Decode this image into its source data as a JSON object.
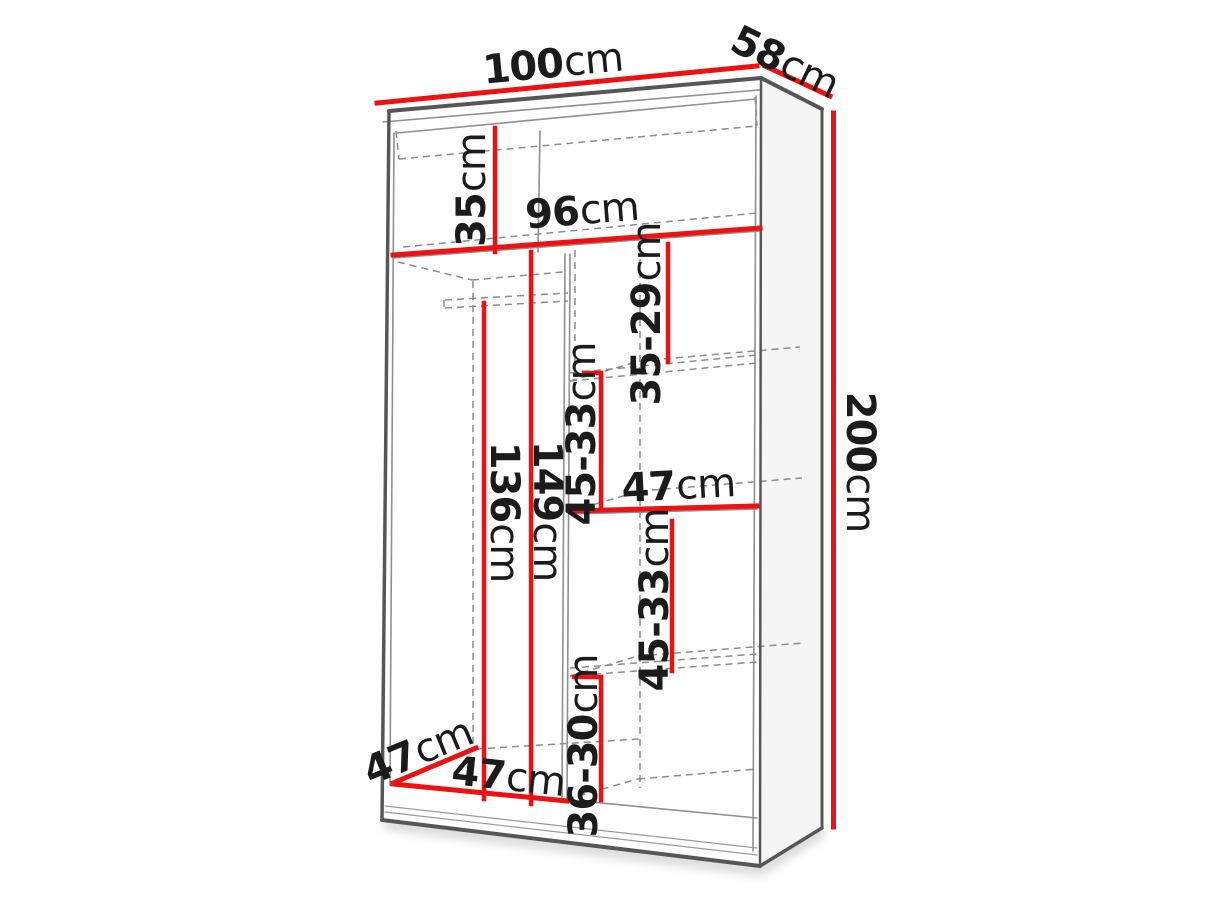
{
  "colors": {
    "dimension_red": "#ee1111",
    "outline_dark": "#565656",
    "outline_light": "#8f8f8f",
    "hidden_line_gray": "#8c8c8c",
    "label_text": "#1b1b1b",
    "side_panel_fill": "#f5f5f5"
  },
  "labels": {
    "top_width": {
      "value": "100",
      "unit": "cm"
    },
    "top_depth": {
      "value": "58",
      "unit": "cm"
    },
    "height": {
      "value": "200",
      "unit": "cm"
    },
    "top_compartment": {
      "value": "35",
      "unit": "cm"
    },
    "interior_width": {
      "value": "96",
      "unit": "cm"
    },
    "right_upper_compartment": {
      "value": "35-29",
      "unit": "cm"
    },
    "right_middle_compartment": {
      "value": "45-33",
      "unit": "cm"
    },
    "hanging_height": {
      "value": "136",
      "unit": "cm"
    },
    "interior_height": {
      "value": "149",
      "unit": "cm"
    },
    "shelf_width": {
      "value": "47",
      "unit": "cm"
    },
    "right_lower_compartment": {
      "value": "45-33",
      "unit": "cm"
    },
    "right_bottom_compartment": {
      "value": "36-30",
      "unit": "cm"
    },
    "interior_depth": {
      "value": "47",
      "unit": "cm"
    },
    "left_section_width": {
      "value": "47",
      "unit": "cm"
    }
  }
}
